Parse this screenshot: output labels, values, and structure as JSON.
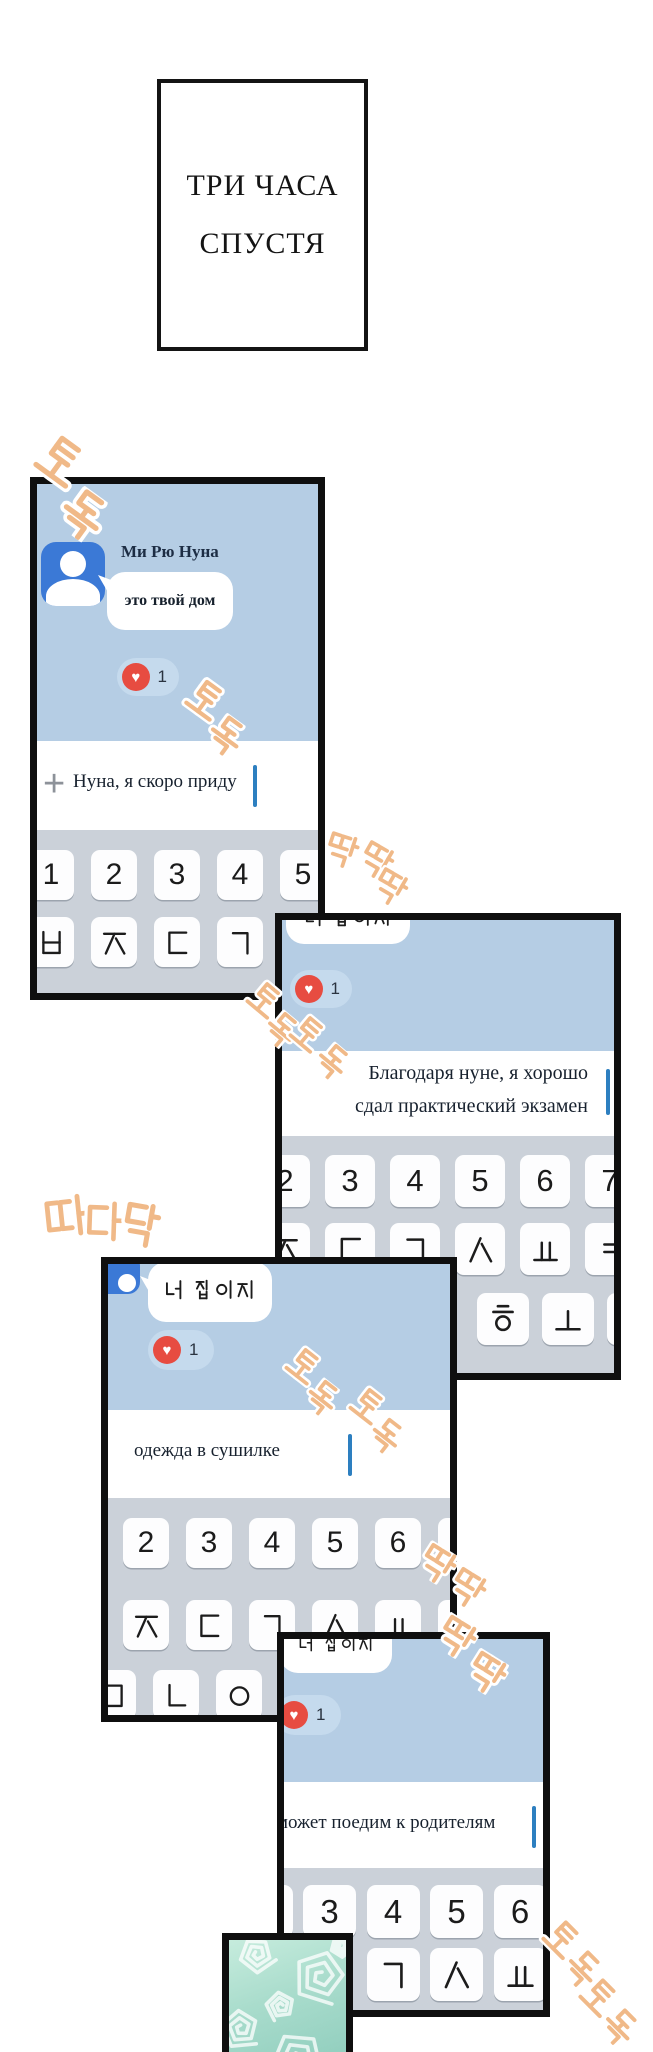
{
  "title": {
    "line1": "ТРИ ЧАСА",
    "line2": "СПУСТЯ"
  },
  "icons": {
    "heart": "♥",
    "plus": "+"
  },
  "colors": {
    "chat_bg": "#b5cde4",
    "keyboard_bg": "#cbd1d9",
    "key_bg": "#fdfdfe",
    "bubble": "#ffffff",
    "avatar_blue": "#3b79d6",
    "heart_red": "#e74c41",
    "reaction_pill": "#c5daed",
    "cursor_blue": "#2d7fc0",
    "sfx_orange": "#f0b988",
    "panel_border": "#0f0f0f",
    "teal_panel": "#a9dccc"
  },
  "panel1": {
    "contact_name": "Ми Рю Нуна",
    "bubble_text": "это твой дом",
    "reaction_count": "1",
    "input_value": "Нуна, я скоро приду",
    "keyboard_rows": [
      [
        "1",
        "2",
        "3",
        "4",
        "5"
      ],
      [
        "ㅂ",
        "ㅈ",
        "ㄷ",
        "ㄱ"
      ]
    ]
  },
  "panel2": {
    "bubble_text": "너 집이지",
    "reaction_count": "1",
    "input_line1": "Благодаря нуне, я хорошо",
    "input_line2": "сдал практический экзамен",
    "keyboard_rows": [
      [
        "2",
        "3",
        "4",
        "5",
        "6",
        "7"
      ],
      [
        "ㅈ",
        "ㄷ",
        "ㄱ",
        "ㅅ",
        "ㅛ",
        "ㅕ"
      ],
      [
        "ㅎ",
        "ㅗ"
      ]
    ]
  },
  "panel3": {
    "bubble_text": "너 집이지",
    "reaction_count": "1",
    "input_value": "одежда в сушилке",
    "keyboard_rows": [
      [
        "2",
        "3",
        "4",
        "5",
        "6"
      ],
      [
        "ㅈ",
        "ㄷ",
        "ㄱ",
        "ㅅ",
        "ㅛ"
      ],
      [
        "ㅁ",
        "ㄴ",
        "ㅇ"
      ]
    ]
  },
  "panel4": {
    "bubble_text": "너 집이지",
    "reaction_count": "1",
    "input_value": "может поедим к родителям",
    "keyboard_rows": [
      [
        "3",
        "4",
        "5",
        "6"
      ],
      [
        "ㄱ",
        "ㅅ",
        "ㅛ"
      ]
    ]
  },
  "sfx": [
    {
      "text": "토독",
      "chars": [
        {
          "ch": "토",
          "x": 36,
          "y": 436,
          "s": 48,
          "r": 36
        },
        {
          "ch": "독",
          "x": 58,
          "y": 490,
          "s": 48,
          "r": 36
        }
      ]
    },
    {
      "text": "토독",
      "chars": [
        {
          "ch": "토",
          "x": 186,
          "y": 680,
          "s": 38,
          "r": 36
        },
        {
          "ch": "독",
          "x": 206,
          "y": 716,
          "s": 38,
          "r": 36
        }
      ]
    },
    {
      "text": "딱딱딱",
      "chars": [
        {
          "ch": "딱",
          "x": 324,
          "y": 833,
          "s": 34,
          "r": 18
        },
        {
          "ch": "딱",
          "x": 358,
          "y": 843,
          "s": 34,
          "r": 30
        },
        {
          "ch": "딱",
          "x": 372,
          "y": 870,
          "s": 34,
          "r": 30
        }
      ]
    },
    {
      "text": "토독토독",
      "chars": [
        {
          "ch": "토",
          "x": 247,
          "y": 982,
          "s": 34,
          "r": 40
        },
        {
          "ch": "독",
          "x": 263,
          "y": 1012,
          "s": 34,
          "r": 40
        },
        {
          "ch": "토",
          "x": 290,
          "y": 1016,
          "s": 34,
          "r": 40
        },
        {
          "ch": "독",
          "x": 314,
          "y": 1044,
          "s": 34,
          "r": 40
        }
      ]
    },
    {
      "text": "따다닥",
      "chars": [
        {
          "ch": "따",
          "x": 44,
          "y": 1194,
          "s": 44,
          "r": -6
        },
        {
          "ch": "다",
          "x": 82,
          "y": 1200,
          "s": 42,
          "r": 2
        },
        {
          "ch": "닥",
          "x": 118,
          "y": 1202,
          "s": 46,
          "r": 10
        }
      ]
    },
    {
      "text": "토독토독",
      "chars": [
        {
          "ch": "토",
          "x": 286,
          "y": 1348,
          "s": 34,
          "r": 38
        },
        {
          "ch": "독",
          "x": 304,
          "y": 1380,
          "s": 34,
          "r": 38
        },
        {
          "ch": "토",
          "x": 350,
          "y": 1388,
          "s": 34,
          "r": 38
        },
        {
          "ch": "독",
          "x": 368,
          "y": 1418,
          "s": 34,
          "r": 38
        }
      ]
    },
    {
      "text": "딱딱딱딱",
      "chars": [
        {
          "ch": "딱",
          "x": 418,
          "y": 1546,
          "s": 36,
          "r": 32
        },
        {
          "ch": "딱",
          "x": 448,
          "y": 1570,
          "s": 36,
          "r": 32
        },
        {
          "ch": "딱",
          "x": 436,
          "y": 1618,
          "s": 38,
          "r": 32
        },
        {
          "ch": "딱",
          "x": 466,
          "y": 1654,
          "s": 38,
          "r": 32
        }
      ]
    },
    {
      "text": "토독토독",
      "chars": [
        {
          "ch": "토",
          "x": 543,
          "y": 1920,
          "s": 36,
          "r": 45
        },
        {
          "ch": "독",
          "x": 563,
          "y": 1950,
          "s": 36,
          "r": 45
        },
        {
          "ch": "토",
          "x": 580,
          "y": 1978,
          "s": 36,
          "r": 45
        },
        {
          "ch": "독",
          "x": 600,
          "y": 2008,
          "s": 36,
          "r": 45
        }
      ]
    }
  ]
}
